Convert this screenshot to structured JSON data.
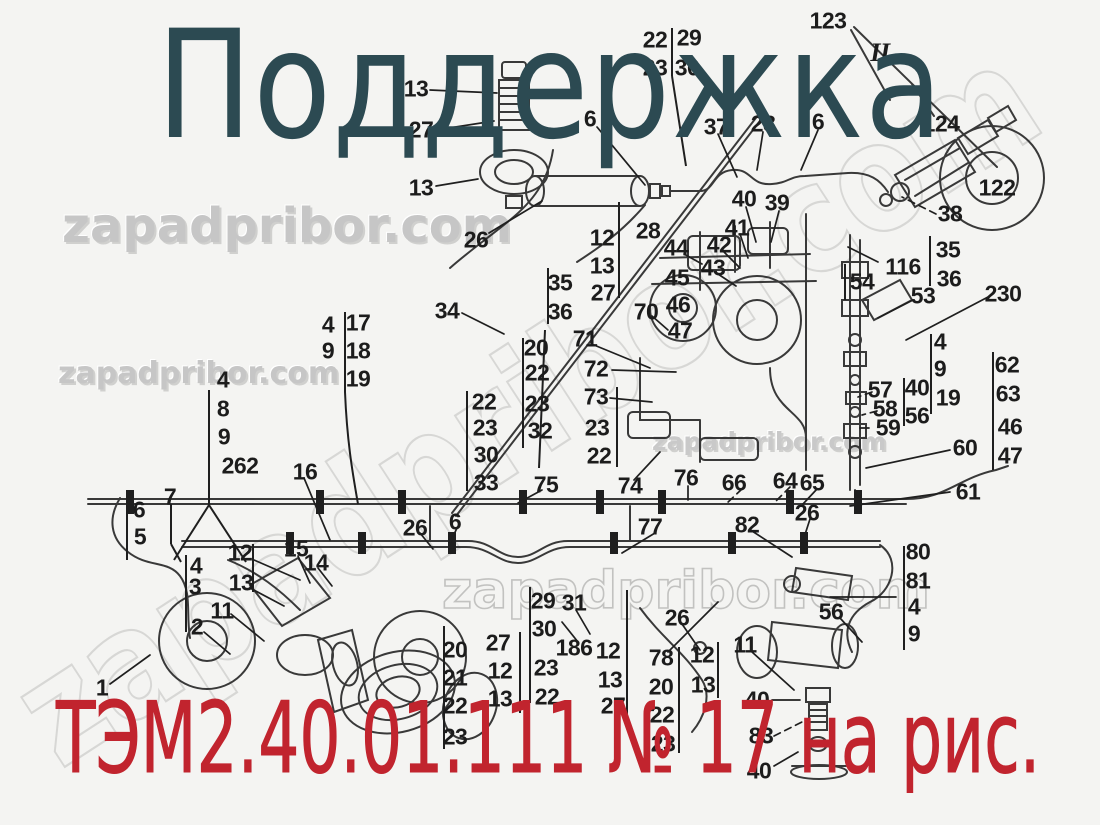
{
  "title": "Поддержка",
  "caption": "ТЭМ2.40.01.111 № 17 на рис.",
  "watermark_text": "zapadpribor.com",
  "figure_marker": "II",
  "colors": {
    "title": "#2c4a52",
    "caption": "#c1242e",
    "labels": "#1c1c1c",
    "watermark": "#c6c6c6",
    "line_art": "#2a2a2a",
    "background": "#f4f4f2"
  },
  "diagram": {
    "labels": [
      {
        "t": "13",
        "x": 416,
        "y": 89
      },
      {
        "t": "27",
        "x": 421,
        "y": 130
      },
      {
        "t": "13",
        "x": 421,
        "y": 188
      },
      {
        "t": "26",
        "x": 476,
        "y": 240
      },
      {
        "t": "6",
        "x": 590,
        "y": 119
      },
      {
        "t": "22",
        "x": 655,
        "y": 40
      },
      {
        "t": "29",
        "x": 689,
        "y": 38
      },
      {
        "t": "23",
        "x": 655,
        "y": 68
      },
      {
        "t": "30",
        "x": 687,
        "y": 68
      },
      {
        "t": "37",
        "x": 716,
        "y": 127
      },
      {
        "t": "28",
        "x": 763,
        "y": 124
      },
      {
        "t": "6",
        "x": 818,
        "y": 122
      },
      {
        "t": "123",
        "x": 828,
        "y": 21
      },
      {
        "t": "II",
        "x": 880,
        "y": 53,
        "roman": true
      },
      {
        "t": "124",
        "x": 941,
        "y": 124
      },
      {
        "t": "122",
        "x": 997,
        "y": 188
      },
      {
        "t": "38",
        "x": 950,
        "y": 214
      },
      {
        "t": "35",
        "x": 948,
        "y": 250
      },
      {
        "t": "116",
        "x": 903,
        "y": 267
      },
      {
        "t": "36",
        "x": 949,
        "y": 279
      },
      {
        "t": "40",
        "x": 744,
        "y": 199
      },
      {
        "t": "39",
        "x": 777,
        "y": 203
      },
      {
        "t": "41",
        "x": 737,
        "y": 228
      },
      {
        "t": "42",
        "x": 719,
        "y": 245
      },
      {
        "t": "44",
        "x": 676,
        "y": 248
      },
      {
        "t": "43",
        "x": 713,
        "y": 268
      },
      {
        "t": "12",
        "x": 602,
        "y": 238
      },
      {
        "t": "13",
        "x": 602,
        "y": 266
      },
      {
        "t": "27",
        "x": 603,
        "y": 293
      },
      {
        "t": "35",
        "x": 560,
        "y": 283
      },
      {
        "t": "36",
        "x": 560,
        "y": 312
      },
      {
        "t": "34",
        "x": 447,
        "y": 311
      },
      {
        "t": "28",
        "x": 648,
        "y": 231
      },
      {
        "t": "45",
        "x": 677,
        "y": 278
      },
      {
        "t": "46",
        "x": 678,
        "y": 305
      },
      {
        "t": "47",
        "x": 680,
        "y": 331
      },
      {
        "t": "70",
        "x": 646,
        "y": 312
      },
      {
        "t": "71",
        "x": 585,
        "y": 339
      },
      {
        "t": "72",
        "x": 596,
        "y": 369
      },
      {
        "t": "73",
        "x": 596,
        "y": 397
      },
      {
        "t": "23",
        "x": 597,
        "y": 428
      },
      {
        "t": "22",
        "x": 599,
        "y": 456
      },
      {
        "t": "54",
        "x": 862,
        "y": 282
      },
      {
        "t": "53",
        "x": 923,
        "y": 296
      },
      {
        "t": "230",
        "x": 1003,
        "y": 294
      },
      {
        "t": "4",
        "x": 940,
        "y": 342
      },
      {
        "t": "9",
        "x": 940,
        "y": 369
      },
      {
        "t": "19",
        "x": 948,
        "y": 398
      },
      {
        "t": "57",
        "x": 880,
        "y": 390
      },
      {
        "t": "58",
        "x": 885,
        "y": 409
      },
      {
        "t": "59",
        "x": 888,
        "y": 428
      },
      {
        "t": "40",
        "x": 917,
        "y": 388
      },
      {
        "t": "56",
        "x": 917,
        "y": 416
      },
      {
        "t": "62",
        "x": 1007,
        "y": 365
      },
      {
        "t": "63",
        "x": 1008,
        "y": 394
      },
      {
        "t": "46",
        "x": 1010,
        "y": 427
      },
      {
        "t": "47",
        "x": 1010,
        "y": 456
      },
      {
        "t": "60",
        "x": 965,
        "y": 448
      },
      {
        "t": "61",
        "x": 968,
        "y": 492
      },
      {
        "t": "4",
        "x": 328,
        "y": 325
      },
      {
        "t": "17",
        "x": 358,
        "y": 323
      },
      {
        "t": "9",
        "x": 328,
        "y": 351
      },
      {
        "t": "18",
        "x": 358,
        "y": 351
      },
      {
        "t": "19",
        "x": 358,
        "y": 379
      },
      {
        "t": "4",
        "x": 223,
        "y": 380
      },
      {
        "t": "8",
        "x": 223,
        "y": 409
      },
      {
        "t": "9",
        "x": 224,
        "y": 437
      },
      {
        "t": "262",
        "x": 240,
        "y": 466
      },
      {
        "t": "16",
        "x": 305,
        "y": 472
      },
      {
        "t": "7",
        "x": 170,
        "y": 497
      },
      {
        "t": "6",
        "x": 139,
        "y": 510
      },
      {
        "t": "5",
        "x": 140,
        "y": 537
      },
      {
        "t": "12",
        "x": 240,
        "y": 553
      },
      {
        "t": "15",
        "x": 296,
        "y": 549
      },
      {
        "t": "14",
        "x": 316,
        "y": 563
      },
      {
        "t": "4",
        "x": 196,
        "y": 566
      },
      {
        "t": "3",
        "x": 195,
        "y": 587
      },
      {
        "t": "13",
        "x": 241,
        "y": 583
      },
      {
        "t": "11",
        "x": 222,
        "y": 611
      },
      {
        "t": "2",
        "x": 197,
        "y": 627
      },
      {
        "t": "1",
        "x": 102,
        "y": 688
      },
      {
        "t": "22",
        "x": 484,
        "y": 402
      },
      {
        "t": "23",
        "x": 485,
        "y": 428
      },
      {
        "t": "30",
        "x": 486,
        "y": 455
      },
      {
        "t": "33",
        "x": 486,
        "y": 483
      },
      {
        "t": "20",
        "x": 536,
        "y": 348
      },
      {
        "t": "22",
        "x": 537,
        "y": 373
      },
      {
        "t": "23",
        "x": 537,
        "y": 404
      },
      {
        "t": "32",
        "x": 540,
        "y": 431
      },
      {
        "t": "75",
        "x": 546,
        "y": 485
      },
      {
        "t": "26",
        "x": 415,
        "y": 528
      },
      {
        "t": "6",
        "x": 455,
        "y": 522
      },
      {
        "t": "74",
        "x": 630,
        "y": 486
      },
      {
        "t": "76",
        "x": 686,
        "y": 478
      },
      {
        "t": "66",
        "x": 734,
        "y": 483
      },
      {
        "t": "64",
        "x": 785,
        "y": 481
      },
      {
        "t": "65",
        "x": 812,
        "y": 483
      },
      {
        "t": "26",
        "x": 807,
        "y": 513
      },
      {
        "t": "82",
        "x": 747,
        "y": 525
      },
      {
        "t": "77",
        "x": 650,
        "y": 527
      },
      {
        "t": "80",
        "x": 918,
        "y": 552
      },
      {
        "t": "81",
        "x": 918,
        "y": 581
      },
      {
        "t": "4",
        "x": 914,
        "y": 607
      },
      {
        "t": "9",
        "x": 914,
        "y": 634
      },
      {
        "t": "56",
        "x": 831,
        "y": 612
      },
      {
        "t": "26",
        "x": 677,
        "y": 618
      },
      {
        "t": "11",
        "x": 745,
        "y": 645
      },
      {
        "t": "29",
        "x": 543,
        "y": 601
      },
      {
        "t": "30",
        "x": 544,
        "y": 629
      },
      {
        "t": "31",
        "x": 574,
        "y": 603
      },
      {
        "t": "186",
        "x": 574,
        "y": 648
      },
      {
        "t": "23",
        "x": 546,
        "y": 668
      },
      {
        "t": "22",
        "x": 547,
        "y": 697
      },
      {
        "t": "20",
        "x": 455,
        "y": 650
      },
      {
        "t": "21",
        "x": 455,
        "y": 678
      },
      {
        "t": "22",
        "x": 455,
        "y": 706
      },
      {
        "t": "23",
        "x": 455,
        "y": 737
      },
      {
        "t": "27",
        "x": 498,
        "y": 643
      },
      {
        "t": "12",
        "x": 500,
        "y": 671
      },
      {
        "t": "13",
        "x": 500,
        "y": 699
      },
      {
        "t": "12",
        "x": 608,
        "y": 651
      },
      {
        "t": "13",
        "x": 610,
        "y": 680
      },
      {
        "t": "27",
        "x": 613,
        "y": 706
      },
      {
        "t": "78",
        "x": 661,
        "y": 658
      },
      {
        "t": "20",
        "x": 661,
        "y": 687
      },
      {
        "t": "22",
        "x": 662,
        "y": 715
      },
      {
        "t": "23",
        "x": 663,
        "y": 744
      },
      {
        "t": "12",
        "x": 702,
        "y": 655
      },
      {
        "t": "13",
        "x": 703,
        "y": 685
      },
      {
        "t": "40",
        "x": 757,
        "y": 700
      },
      {
        "t": "83",
        "x": 761,
        "y": 736
      },
      {
        "t": "40",
        "x": 759,
        "y": 771
      }
    ]
  }
}
